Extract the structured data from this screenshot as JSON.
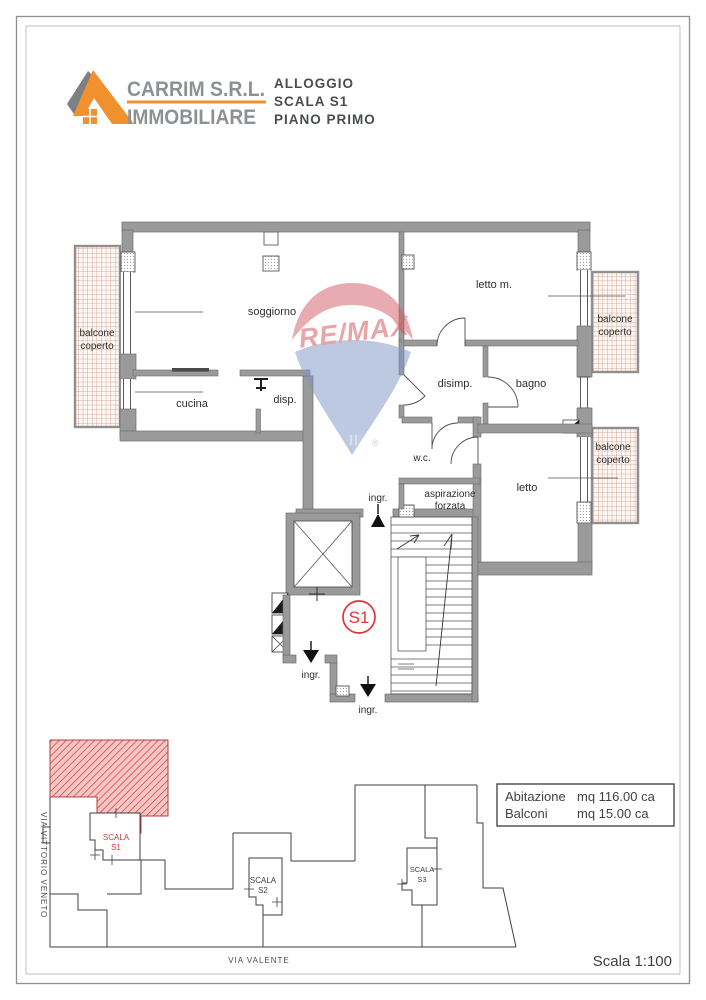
{
  "header": {
    "company_name": "CARRIM S.R.L.",
    "company_sub": "IMMOBILIARE",
    "logo_orange": "#F0912D",
    "logo_gray": "#7D7F82",
    "doc_lines": [
      "ALLOGGIO",
      "SCALA S1",
      "PIANO PRIMO"
    ]
  },
  "watermark": {
    "brand": "RE/MAX",
    "registered": "®",
    "balloon_red": "#D2606A",
    "balloon_blue": "#7F98C5",
    "text_red": "#D6525E"
  },
  "plan": {
    "wall_color": "#9A9A9A",
    "badge_color": "#E03338",
    "balcony_hatch_color": "#C98F7C",
    "unit_badge": "S1",
    "rooms": [
      {
        "id": "soggiorno",
        "label": "soggiorno"
      },
      {
        "id": "cucina",
        "label": "cucina"
      },
      {
        "id": "disp",
        "label": "disp."
      },
      {
        "id": "letto-m",
        "label": "letto m."
      },
      {
        "id": "disimp",
        "label": "disimp."
      },
      {
        "id": "bagno",
        "label": "bagno"
      },
      {
        "id": "wc",
        "label": "w.c."
      },
      {
        "id": "letto",
        "label": "letto"
      }
    ],
    "aspirazione": {
      "line1": "aspirazione",
      "line2": "forzata"
    },
    "balconies": [
      {
        "line1": "balcone",
        "line2": "coperto"
      },
      {
        "line1": "balcone",
        "line2": "coperto"
      },
      {
        "line1": "balcone",
        "line2": "coperto"
      }
    ],
    "entrances": [
      {
        "label": "ingr."
      },
      {
        "label": "ingr."
      },
      {
        "label": "ingr."
      }
    ]
  },
  "site_plan": {
    "highlight_color": "#D94F4F",
    "stairs": [
      {
        "line1": "SCALA",
        "line2": "S1",
        "highlighted": true
      },
      {
        "line1": "SCALA",
        "line2": "S2",
        "highlighted": false
      },
      {
        "line1": "SCALA",
        "line2": "S3",
        "highlighted": false
      }
    ],
    "streets": [
      {
        "name": "VIA VITTORIO VENETO",
        "orientation": "vertical"
      },
      {
        "name": "VIA VALENTE",
        "orientation": "horizontal"
      }
    ]
  },
  "info_box": {
    "rows": [
      {
        "label": "Abitazione",
        "value": "mq 116.00 ca"
      },
      {
        "label": "Balconi",
        "value": "mq 15.00 ca"
      }
    ]
  },
  "scale_note": "Scala 1:100"
}
